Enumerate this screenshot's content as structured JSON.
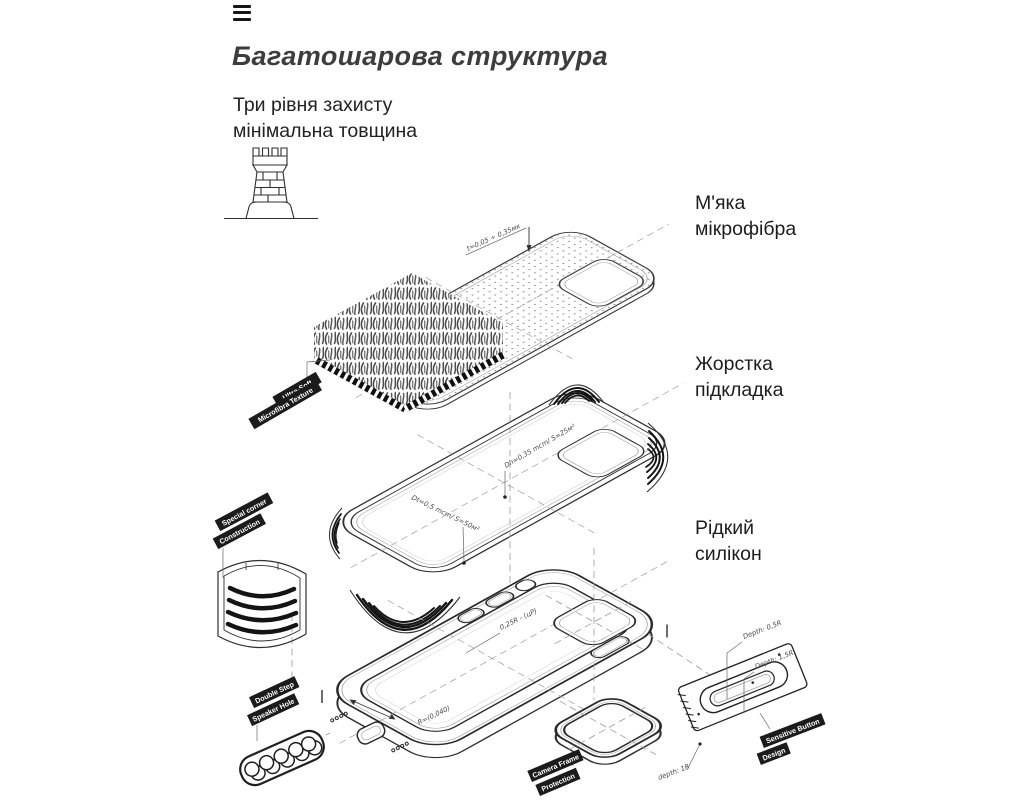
{
  "header": {
    "title": "Багатошарова структура",
    "subtitle_line1": "Три рівня захисту",
    "subtitle_line2": "мінімальна товщина"
  },
  "layer_labels": {
    "microfiber": {
      "line1": "М'яка",
      "line2": "мікрофібра"
    },
    "lining": {
      "line1": "Жорстка",
      "line2": "підкладка"
    },
    "silicone": {
      "line1": "Рідкий",
      "line2": "силікон"
    }
  },
  "tags": {
    "microfiber": [
      "Ultra-Soft",
      "Microfibra Texture"
    ],
    "corner": [
      "Special corner",
      "Construction"
    ],
    "speaker": [
      "Double Step",
      "Speaker Hole"
    ],
    "camera": [
      "Camera Frame",
      "Protection"
    ],
    "button": [
      "Sensitive Button",
      "Design"
    ]
  },
  "annotations": {
    "thickness": "t=0,05 ÷ 0,35мк",
    "hard_layer": "Dh=0,35 mcm/ S=25м²",
    "soft_layer": "Dt=0,5 mcm/ S=50м²",
    "radius": "0,25R - (цР)",
    "inner_radius": "R=(0,040)",
    "depth_top": "Depth: 0,5R",
    "depth_mid": "Depth: 1,5R",
    "depth_bottom": "depth: 1R"
  },
  "colors": {
    "ink": "#2a2a2a",
    "title": "#3d3d3d",
    "tag_bg": "#1b1b1b",
    "tag_text": "#ffffff",
    "annotation": "#4a4a4a",
    "dash": "#9b9b9b",
    "background": "#ffffff"
  }
}
